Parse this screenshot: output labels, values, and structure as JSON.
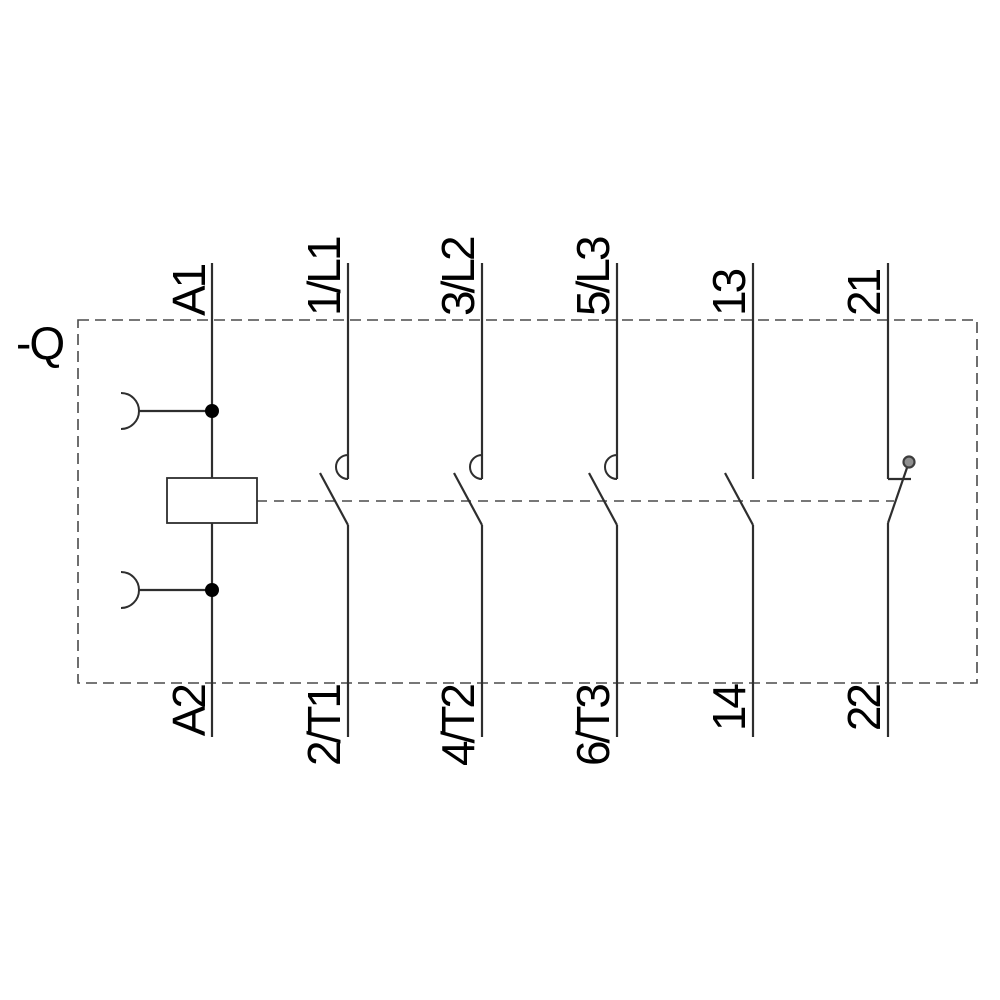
{
  "diagram": {
    "device_label": "-Q",
    "coil": {
      "top_terminal": "A1",
      "bottom_terminal": "A2"
    },
    "poles": [
      {
        "id": "main-pole-1",
        "type": "main-contact-no",
        "top_terminal": "1/L1",
        "bottom_terminal": "2/T1"
      },
      {
        "id": "main-pole-2",
        "type": "main-contact-no",
        "top_terminal": "3/L2",
        "bottom_terminal": "4/T2"
      },
      {
        "id": "main-pole-3",
        "type": "main-contact-no",
        "top_terminal": "5/L3",
        "bottom_terminal": "6/T3"
      },
      {
        "id": "aux-pole-no",
        "type": "aux-contact-no",
        "top_terminal": "13",
        "bottom_terminal": "14"
      },
      {
        "id": "aux-pole-nc",
        "type": "aux-contact-nc",
        "top_terminal": "21",
        "bottom_terminal": "22"
      }
    ],
    "colors": {
      "line": "#2e2e2e",
      "dash": "#4a4a4a",
      "text": "#000000",
      "pivot_fill": "#8f8f8f",
      "pivot_stroke": "#3d3d3d",
      "background": "#ffffff"
    }
  }
}
